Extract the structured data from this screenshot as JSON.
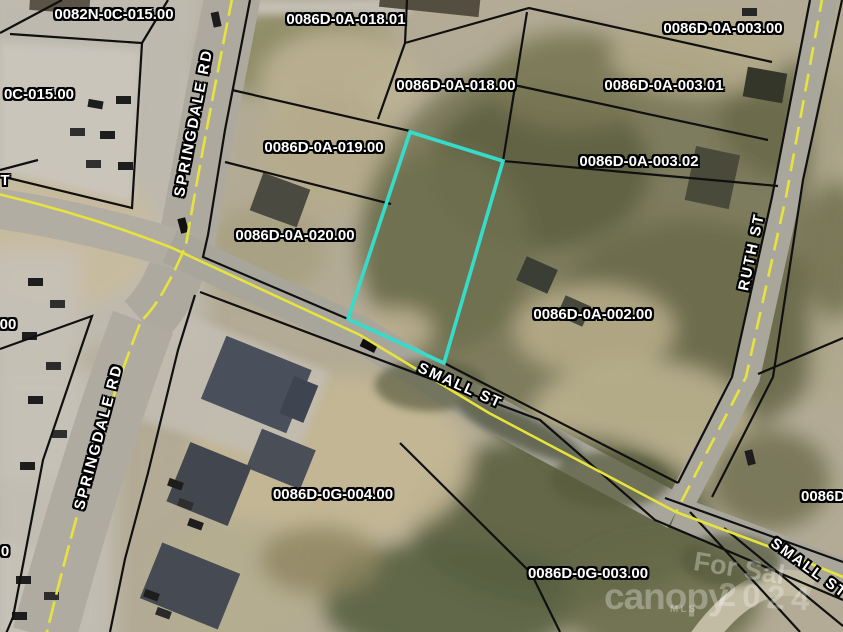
{
  "map": {
    "parcel_labels": [
      {
        "text": "0082N-0C-015.00"
      },
      {
        "text": "0086D-0A-018.01"
      },
      {
        "text": "0086D-0A-003.00"
      },
      {
        "text": "0086D-0A-018.00"
      },
      {
        "text": "0086D-0A-003.01"
      },
      {
        "text": "0C-015.00"
      },
      {
        "text": "0086D-0A-019.00"
      },
      {
        "text": "0086D-0A-003.02"
      },
      {
        "text": "T"
      },
      {
        "text": "0086D-0A-020.00"
      },
      {
        "text": "0086D-0A-002.00"
      },
      {
        "text": "00"
      },
      {
        "text": "0086D-0G-004.00"
      },
      {
        "text": "0086D"
      },
      {
        "text": "0"
      },
      {
        "text": "0086D-0G-003.00"
      }
    ],
    "street_labels": [
      {
        "text": "SPRINGDALE RD"
      },
      {
        "text": "SPRINGDALE RD"
      },
      {
        "text": "RUTH ST"
      },
      {
        "text": "SMALL ST"
      },
      {
        "text": "SMALL ST"
      }
    ],
    "watermark": {
      "overlay": "For Sal",
      "brand": "canopy",
      "brand_sub": "MLS",
      "year": "2024"
    },
    "colors": {
      "highlight": "#36DCCA",
      "road_centerline": "#E6E33E",
      "parcel_line": "#101010",
      "label_text": "#FFFFFF",
      "label_outline": "#000000"
    }
  }
}
